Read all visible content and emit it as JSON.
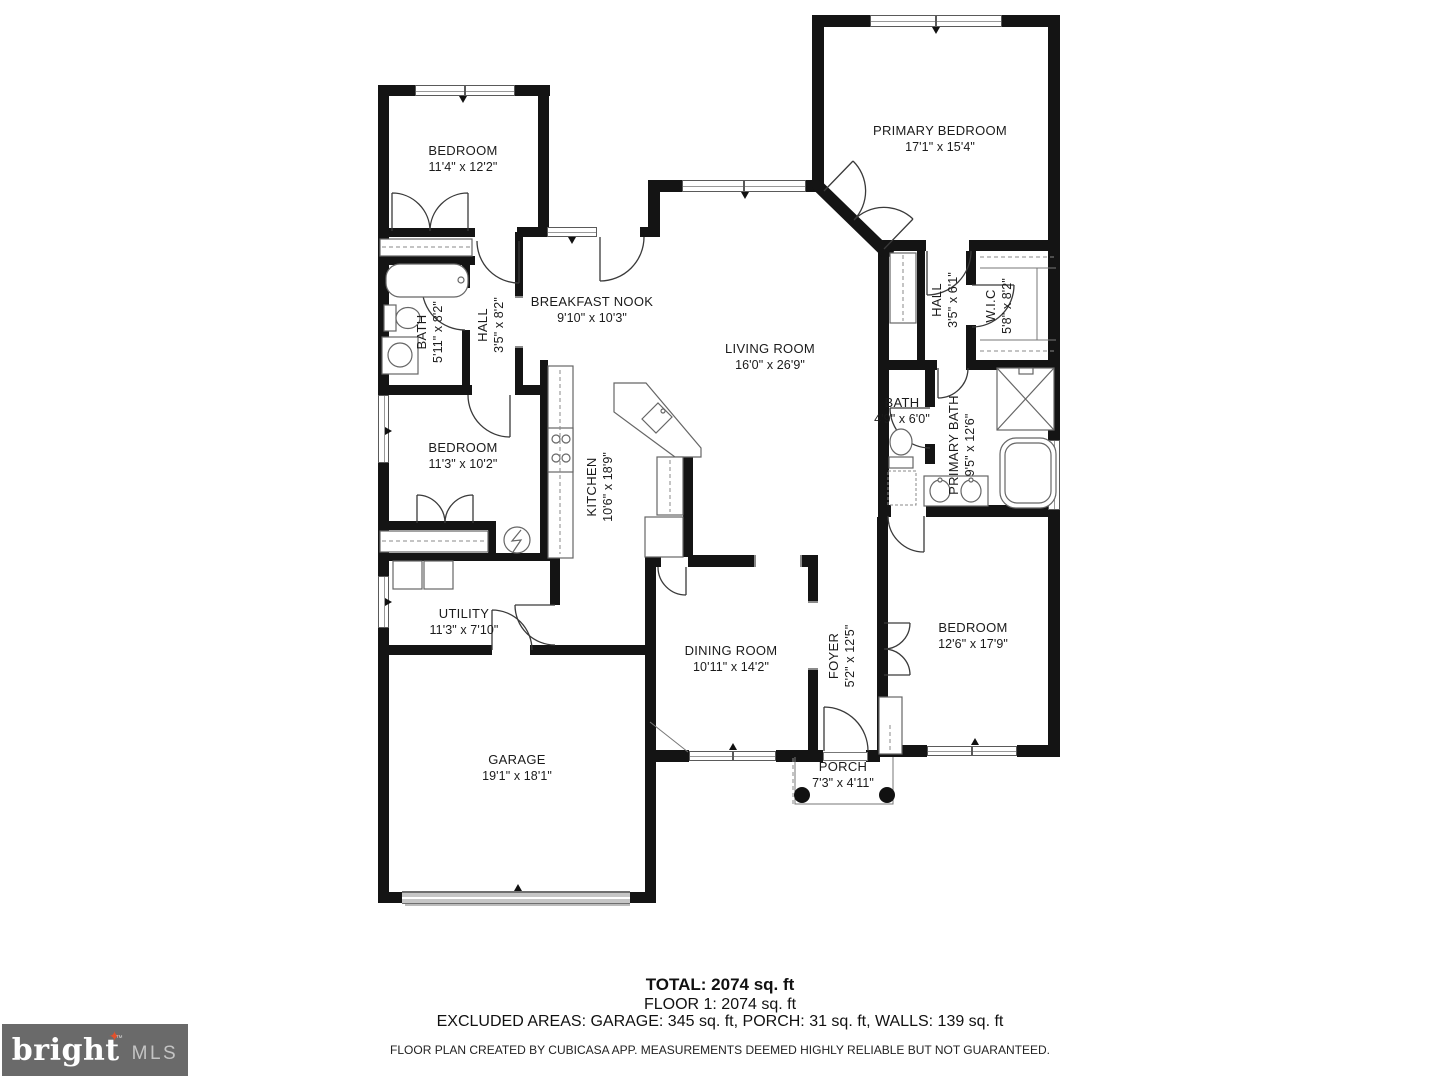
{
  "rooms": [
    {
      "id": "bedroom-top-left",
      "name": "BEDROOM",
      "dims": "11'4\" x 12'2\""
    },
    {
      "id": "primary-bedroom",
      "name": "PRIMARY BEDROOM",
      "dims": "17'1\" x 15'4\""
    },
    {
      "id": "bath-left",
      "name": "BATH",
      "dims": "5'11\" x 8'2\""
    },
    {
      "id": "hall-left",
      "name": "HALL",
      "dims": "3'5\" x 8'2\""
    },
    {
      "id": "breakfast-nook",
      "name": "BREAKFAST NOOK",
      "dims": "9'10\" x 10'3\""
    },
    {
      "id": "living-room",
      "name": "LIVING ROOM",
      "dims": "16'0\" x 26'9\""
    },
    {
      "id": "bedroom-left",
      "name": "BEDROOM",
      "dims": "11'3\" x 10'2\""
    },
    {
      "id": "kitchen",
      "name": "KITCHEN",
      "dims": "10'6\" x 18'9\""
    },
    {
      "id": "hall-right",
      "name": "HALL",
      "dims": "3'5\" x 6'1\""
    },
    {
      "id": "walk-in-closet",
      "name": "W.I.C",
      "dims": "5'8\" x 8'2\""
    },
    {
      "id": "bath-right",
      "name": "BATH",
      "dims": "4'9\" x 6'0\""
    },
    {
      "id": "primary-bath",
      "name": "PRIMARY BATH",
      "dims": "9'5\" x 12'6\""
    },
    {
      "id": "utility",
      "name": "UTILITY",
      "dims": "11'3\" x 7'10\""
    },
    {
      "id": "dining-room",
      "name": "DINING ROOM",
      "dims": "10'11\" x 14'2\""
    },
    {
      "id": "foyer",
      "name": "FOYER",
      "dims": "5'2\" x 12'5\""
    },
    {
      "id": "bedroom-right",
      "name": "BEDROOM",
      "dims": "12'6\" x 17'9\""
    },
    {
      "id": "garage",
      "name": "GARAGE",
      "dims": "19'1\" x 18'1\""
    },
    {
      "id": "porch",
      "name": "PORCH",
      "dims": "7'3\" x 4'11\""
    }
  ],
  "footer": {
    "total": "TOTAL: 2074 sq. ft",
    "floor": "FLOOR 1: 2074 sq. ft",
    "excluded": "EXCLUDED AREAS: GARAGE: 345 sq. ft, PORCH: 31 sq. ft, WALLS: 139 sq. ft",
    "disclaimer": "FLOOR PLAN CREATED BY CUBICASA APP. MEASUREMENTS DEEMED HIGHLY RELIABLE BUT NOT GUARANTEED."
  },
  "logo": {
    "brand": "bright",
    "sparkle": "✦",
    "tm": "™",
    "suffix": "MLS"
  },
  "colors": {
    "wall": "#141414",
    "door_line": "#3a3a3a",
    "fixture_line": "#666666",
    "logo_bg": "#6a6a6a",
    "logo_brand": "#ffffff",
    "logo_mls": "#c4c4c4",
    "sparkle": "#e0512c"
  }
}
